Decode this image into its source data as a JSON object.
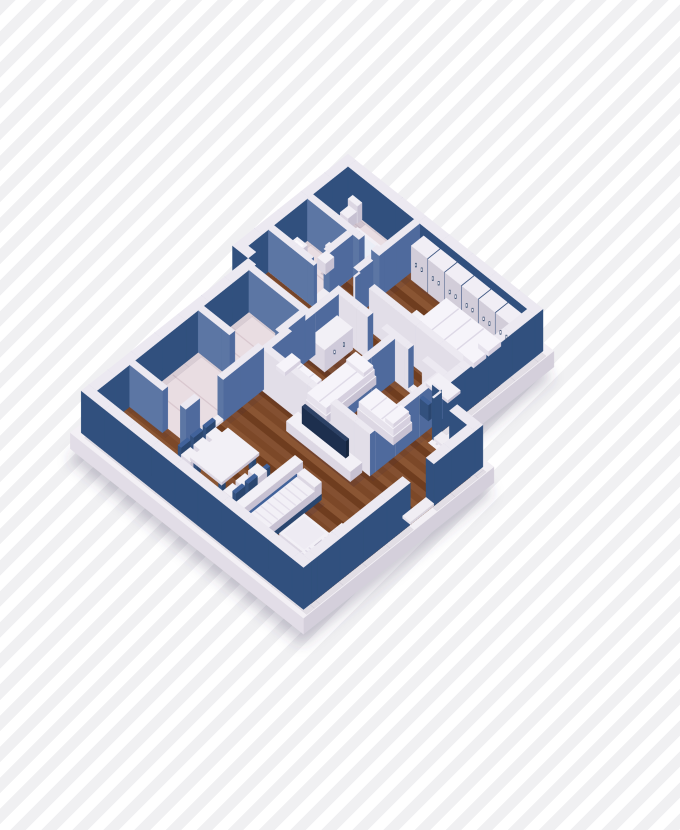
{
  "meta": {
    "title": "isometric-apartment-floorplan-render",
    "width": 680,
    "height": 830
  },
  "background": {
    "stripe_color": "#f0f0f2",
    "stripe_gap_color": "#ffffff",
    "stripe_width": 11,
    "angle_deg": 135
  },
  "projection": {
    "cx": 348,
    "cy": 196,
    "ux": 0.78,
    "uy": 0.62,
    "wall_height": 42,
    "slab_depth": 16
  },
  "colors": {
    "ext": {
      "t": "#ece9f1",
      "x": "#31507e",
      "y": "#31507e"
    },
    "intw": {
      "t": "#ece9f1",
      "x": "#4f6a9d",
      "y": "#5c76a4"
    },
    "intl": {
      "t": "#ece9f1",
      "x": "#4f6a9d",
      "y": "#e2dee8"
    },
    "furn": {
      "t": "#f2f0f6",
      "x": "#c7c1d2",
      "y": "#dcd7e3"
    },
    "ward": {
      "t": "#f1eef5",
      "x": "#3a5480",
      "y": "#d2cdd9"
    },
    "navy": {
      "t": "#41629a",
      "x": "#2a466f",
      "y": "#33517e"
    },
    "blank": {
      "t": "#f6f4fa",
      "x": "#d6d0df",
      "y": "#e6e2ec"
    },
    "th": {
      "t": "#f0edf3",
      "x": "#d8d3de",
      "y": "#e4e0e9"
    },
    "slab": {
      "t": "#f3f0f5",
      "x": "#d4cfdb",
      "y": "#e2dde7"
    },
    "tv": {
      "t": "#2c4165",
      "x": "#16263f",
      "y": "#1d2f4e"
    },
    "wood": [
      "#7c4828",
      "#8a5533",
      "#6f3d1f",
      "#845031"
    ],
    "marble": "#e9dde2",
    "vein": "#d9c8cf",
    "shadow": "rgba(60,45,80,0.14)",
    "ground_shadow": "rgba(70,60,95,0.28)",
    "handle_dark": "#2e4568",
    "handle_light": "#f5f3f8"
  },
  "slab": [
    [
      -7,
      -7,
      257,
      155,
      -16,
      0
    ],
    [
      13,
      125,
      312,
      369,
      -16,
      0
    ]
  ],
  "floors": {
    "wood": [
      [
        10,
        55,
        250,
        148
      ],
      [
        20,
        148,
        305,
        352
      ],
      [
        102,
        10,
        240,
        95
      ]
    ],
    "marble": [
      [
        10,
        10,
        95,
        55
      ],
      [
        10,
        62,
        68,
        112
      ],
      [
        30,
        157,
        95,
        215
      ],
      [
        30,
        222,
        95,
        303
      ]
    ]
  },
  "walls": [
    [
      0,
      0,
      10,
      148,
      "ext"
    ],
    [
      10,
      0,
      250,
      10,
      "ext"
    ],
    [
      240,
      10,
      250,
      132,
      "ext"
    ],
    [
      250,
      132,
      252,
      142,
      "ext"
    ],
    [
      272,
      132,
      305,
      142,
      "ext"
    ],
    [
      295,
      142,
      305,
      195,
      "ext"
    ],
    [
      295,
      225,
      305,
      352,
      "ext"
    ],
    [
      20,
      352,
      305,
      362,
      "ext"
    ],
    [
      20,
      148,
      30,
      352,
      "ext"
    ],
    [
      0,
      138,
      20,
      148,
      "ext"
    ],
    [
      10,
      55,
      76,
      62,
      "intw"
    ],
    [
      92,
      55,
      102,
      62,
      "intw"
    ],
    [
      95,
      10,
      102,
      88,
      "intw"
    ],
    [
      61,
      62,
      68,
      92,
      "intw"
    ],
    [
      61,
      108,
      68,
      112,
      "intw"
    ],
    [
      10,
      105,
      61,
      112,
      "intw"
    ],
    [
      102,
      88,
      104,
      95,
      "intl"
    ],
    [
      122,
      88,
      240,
      95,
      "intl"
    ],
    [
      100,
      112,
      144,
      119,
      "intl"
    ],
    [
      162,
      112,
      196,
      119,
      "intl"
    ],
    [
      214,
      112,
      240,
      119,
      "intl"
    ],
    [
      100,
      119,
      107,
      205,
      "intl"
    ],
    [
      100,
      205,
      240,
      212,
      "intl"
    ],
    [
      172,
      119,
      179,
      205,
      "intl"
    ],
    [
      233,
      119,
      240,
      205,
      "intl"
    ],
    [
      30,
      150,
      102,
      157,
      "intw"
    ],
    [
      95,
      157,
      102,
      188,
      "intw"
    ],
    [
      95,
      210,
      102,
      262,
      "intw"
    ],
    [
      95,
      292,
      102,
      310,
      "intw"
    ],
    [
      30,
      215,
      70,
      222,
      "intw"
    ],
    [
      30,
      303,
      72,
      310,
      "intw"
    ]
  ],
  "thresholds": [
    [
      76,
      55,
      92,
      62
    ],
    [
      61,
      92,
      68,
      108
    ],
    [
      104,
      88,
      122,
      95
    ],
    [
      144,
      112,
      162,
      119
    ],
    [
      196,
      112,
      214,
      119
    ],
    [
      95,
      188,
      102,
      210
    ],
    [
      95,
      262,
      102,
      292
    ],
    [
      252,
      132,
      272,
      142
    ],
    [
      295,
      195,
      305,
      225
    ]
  ],
  "furniture": [
    {
      "n": "toilet-a-tank",
      "b": [
        16,
        10,
        28,
        16,
        0,
        17
      ],
      "t": "furn"
    },
    {
      "n": "toilet-a-bowl",
      "b": [
        17,
        16,
        27,
        27,
        0,
        11
      ],
      "t": "furn",
      "o": 1
    },
    {
      "n": "bathtub",
      "b": [
        40,
        28,
        92,
        52,
        0,
        11
      ],
      "t": "furn",
      "deco": [
        [
          44,
          31.5,
          88,
          48.5,
          "#eaeef6"
        ]
      ]
    },
    {
      "n": "washing-machine",
      "b": [
        82,
        13,
        95,
        26,
        0,
        16
      ],
      "t": "furn",
      "fy": "#d0cad9",
      "deco": [
        [
          84,
          15,
          93,
          24,
          "#e9e5ef"
        ]
      ]
    },
    {
      "n": "wc-sink",
      "b": [
        11,
        76,
        24,
        96,
        0,
        13
      ],
      "t": "furn",
      "deco": [
        [
          13,
          79,
          22,
          93,
          "#fbfafd"
        ]
      ]
    },
    {
      "n": "wc-toilet-tank",
      "b": [
        38,
        62,
        50,
        67,
        0,
        16
      ],
      "t": "furn"
    },
    {
      "n": "wc-toilet-bowl",
      "b": [
        39,
        67,
        49,
        78,
        0,
        11
      ],
      "t": "furn",
      "o": 1
    },
    {
      "n": "wardrobe-1",
      "b": [
        108,
        11,
        128.5,
        27,
        0,
        34
      ],
      "t": "ward"
    },
    {
      "n": "wardrobe-2",
      "b": [
        129.7,
        11,
        150.2,
        27,
        0,
        34
      ],
      "t": "ward"
    },
    {
      "n": "wardrobe-3",
      "b": [
        151.4,
        11,
        171.9,
        27,
        0,
        34
      ],
      "t": "ward"
    },
    {
      "n": "wardrobe-4",
      "b": [
        173.1,
        11,
        193.6,
        27,
        0,
        34
      ],
      "t": "ward"
    },
    {
      "n": "wardrobe-5",
      "b": [
        194.8,
        11,
        215.3,
        27,
        0,
        34
      ],
      "t": "ward"
    },
    {
      "n": "wardrobe-6",
      "b": [
        216.5,
        11,
        237,
        27,
        0,
        34
      ],
      "t": "ward"
    },
    {
      "n": "double-bed-base",
      "b": [
        158,
        32,
        235,
        74,
        0,
        9
      ],
      "t": "furn",
      "fy": "#cfc9dc"
    },
    {
      "n": "double-bed-blanket",
      "b": [
        159,
        33,
        234,
        73,
        9,
        17
      ],
      "t": "blank",
      "ribs": {
        "axis": "x",
        "step": 16,
        "c": "#ddd8e6"
      }
    },
    {
      "n": "double-bed-pillow-1",
      "b": [
        220,
        37,
        233,
        53,
        17,
        22
      ],
      "t": "blank",
      "o": 2
    },
    {
      "n": "double-bed-pillow-2",
      "b": [
        220,
        56,
        233,
        72,
        17,
        22
      ],
      "t": "blank",
      "o": 2
    },
    {
      "n": "bed-bench",
      "b": [
        144,
        56,
        158,
        72,
        0,
        10
      ],
      "t": "furn"
    },
    {
      "n": "desk-top",
      "b": [
        212,
        96,
        240,
        112,
        11,
        14
      ],
      "t": "furn",
      "o": 1
    },
    {
      "n": "desk-leg-1",
      "b": [
        213,
        97,
        217,
        101,
        0,
        11
      ],
      "t": "navy"
    },
    {
      "n": "desk-leg-2",
      "b": [
        235,
        97,
        239,
        101,
        0,
        11
      ],
      "t": "navy"
    },
    {
      "n": "desk-leg-3",
      "b": [
        213,
        107,
        217,
        111,
        0,
        11
      ],
      "t": "navy"
    },
    {
      "n": "desk-leg-4",
      "b": [
        235,
        107,
        239,
        111,
        0,
        11
      ],
      "t": "navy"
    },
    {
      "n": "desk-chair-seat",
      "b": [
        222,
        115,
        233,
        126,
        0,
        8
      ],
      "t": "furn"
    },
    {
      "n": "desk-chair-back",
      "b": [
        222,
        126,
        233,
        130,
        0,
        16
      ],
      "t": "navy",
      "o": 1
    },
    {
      "n": "kids-cabinet",
      "b": [
        107,
        121,
        127,
        157,
        0,
        22
      ],
      "t": "furn",
      "fx": "#cfcada"
    },
    {
      "n": "kids-bed-a-base",
      "b": [
        144,
        134,
        170,
        198,
        0,
        8
      ],
      "t": "furn"
    },
    {
      "n": "kids-bed-a-blanket",
      "b": [
        145,
        135,
        169,
        197,
        8,
        15
      ],
      "t": "blank",
      "ribs": {
        "axis": "x",
        "step": 14,
        "c": "#e0dbe8"
      }
    },
    {
      "n": "kids-bed-a-pillow",
      "b": [
        146,
        136,
        168,
        148,
        15,
        19
      ],
      "t": "blank",
      "o": 2
    },
    {
      "n": "kids-bed-b-base",
      "b": [
        104,
        176,
        144,
        200,
        0,
        8
      ],
      "t": "furn"
    },
    {
      "n": "kids-bed-b-blanket",
      "b": [
        105,
        177,
        143,
        199,
        8,
        15
      ],
      "t": "blank",
      "ribs": {
        "axis": "x",
        "step": 14,
        "c": "#e0dbe8"
      }
    },
    {
      "n": "kids-bed-b-pillow",
      "b": [
        106,
        178,
        117,
        198,
        15,
        19
      ],
      "t": "blank",
      "o": 2
    },
    {
      "n": "kids-bed-c-base",
      "b": [
        184,
        148,
        230,
        172,
        0,
        8
      ],
      "t": "furn"
    },
    {
      "n": "kids-bed-c-blanket",
      "b": [
        185,
        149,
        229,
        171,
        8,
        15
      ],
      "t": "blank",
      "ribs": {
        "axis": "x",
        "step": 14,
        "c": "#e0dbe8"
      }
    },
    {
      "n": "kids-bed-c-pillow",
      "b": [
        218,
        150,
        228,
        170,
        15,
        19
      ],
      "t": "blank",
      "o": 2
    },
    {
      "n": "tv-console",
      "b": [
        150,
        214,
        232,
        229,
        0,
        10
      ],
      "t": "furn"
    },
    {
      "n": "tv-screen",
      "b": [
        162,
        217,
        218,
        221,
        10,
        27
      ],
      "t": "tv",
      "o": 1
    },
    {
      "n": "dining-table-top",
      "b": [
        122,
        276,
        162,
        324,
        12,
        15
      ],
      "t": "furn",
      "o": 1
    },
    {
      "n": "table-leg-1",
      "b": [
        124,
        278,
        128,
        283,
        0,
        12
      ],
      "t": "navy"
    },
    {
      "n": "table-leg-2",
      "b": [
        156,
        278,
        160,
        283,
        0,
        12
      ],
      "t": "navy"
    },
    {
      "n": "table-leg-3",
      "b": [
        124,
        317,
        128,
        322,
        0,
        12
      ],
      "t": "navy"
    },
    {
      "n": "table-leg-4",
      "b": [
        156,
        317,
        160,
        322,
        0,
        12
      ],
      "t": "navy"
    },
    {
      "n": "chair-l1-seat",
      "b": [
        108,
        278,
        120,
        290,
        0,
        8
      ],
      "t": "furn"
    },
    {
      "n": "chair-l1-back",
      "b": [
        104,
        278,
        108,
        290,
        0,
        15
      ],
      "t": "navy"
    },
    {
      "n": "chair-l2-seat",
      "b": [
        108,
        294,
        120,
        306,
        0,
        8
      ],
      "t": "furn"
    },
    {
      "n": "chair-l2-back",
      "b": [
        104,
        294,
        108,
        306,
        0,
        15
      ],
      "t": "navy"
    },
    {
      "n": "chair-l3-seat",
      "b": [
        108,
        310,
        120,
        322,
        0,
        8
      ],
      "t": "furn"
    },
    {
      "n": "chair-l3-back",
      "b": [
        104,
        310,
        108,
        322,
        0,
        15
      ],
      "t": "navy"
    },
    {
      "n": "chair-r1-seat",
      "b": [
        164,
        280,
        176,
        292,
        0,
        8
      ],
      "t": "furn"
    },
    {
      "n": "chair-r1-back",
      "b": [
        176,
        280,
        180,
        292,
        0,
        15
      ],
      "t": "navy"
    },
    {
      "n": "chair-r2-seat",
      "b": [
        164,
        296,
        176,
        308,
        0,
        8
      ],
      "t": "furn"
    },
    {
      "n": "chair-r2-back",
      "b": [
        176,
        296,
        180,
        308,
        0,
        15
      ],
      "t": "navy"
    },
    {
      "n": "chair-r3-seat",
      "b": [
        164,
        312,
        176,
        324,
        0,
        8
      ],
      "t": "furn"
    },
    {
      "n": "chair-r3-back",
      "b": [
        176,
        312,
        180,
        324,
        0,
        15
      ],
      "t": "navy"
    },
    {
      "n": "sofa-base",
      "b": [
        196,
        262,
        228,
        348,
        0,
        6
      ],
      "t": "navy"
    },
    {
      "n": "sofa-back",
      "b": [
        196,
        264,
        206,
        346,
        6,
        26
      ],
      "t": "furn",
      "o": 1
    },
    {
      "n": "sofa-arm-1",
      "b": [
        206,
        262,
        228,
        271,
        6,
        18
      ],
      "t": "furn",
      "o": 1
    },
    {
      "n": "sofa-arm-2",
      "b": [
        206,
        339,
        228,
        348,
        6,
        18
      ],
      "t": "furn",
      "o": 1
    },
    {
      "n": "sofa-seat",
      "b": [
        205,
        271,
        228,
        339,
        6,
        14
      ],
      "t": "furn",
      "o": 1,
      "ribs": {
        "axis": "y",
        "step": 7.6,
        "c": "#e4dfeb"
      }
    },
    {
      "n": "coffee-table",
      "b": [
        236,
        292,
        268,
        324,
        0,
        10
      ],
      "t": "furn",
      "deco": [
        [
          239,
          295,
          265,
          321,
          "#eeebf3"
        ]
      ]
    },
    {
      "n": "armchair-1-base",
      "b": [
        270,
        278,
        294,
        306,
        0,
        4
      ],
      "t": "navy"
    },
    {
      "n": "armchair-1-cushion",
      "b": [
        271,
        279,
        289,
        305,
        4,
        14
      ],
      "t": "furn",
      "o": 1,
      "ribs": {
        "axis": "y",
        "step": 4.4,
        "c": "#e0dbe8"
      }
    },
    {
      "n": "armchair-1-back",
      "b": [
        289,
        278,
        294,
        306,
        4,
        17
      ],
      "t": "furn",
      "o": 1
    },
    {
      "n": "armchair-2-base",
      "b": [
        268,
        314,
        292,
        340,
        0,
        4
      ],
      "t": "navy"
    },
    {
      "n": "armchair-2-cushion",
      "b": [
        269,
        315,
        287,
        339,
        4,
        14
      ],
      "t": "furn",
      "o": 1,
      "ribs": {
        "axis": "y",
        "step": 4.4,
        "c": "#e0dbe8"
      }
    },
    {
      "n": "armchair-2-back",
      "b": [
        287,
        314,
        292,
        340,
        4,
        17
      ],
      "t": "furn",
      "o": 1
    }
  ],
  "handles": {
    "wardrobe_y": {
      "y": 27.6,
      "z": 19,
      "xs": [
        114.5,
        122,
        136.2,
        143.7,
        157.9,
        165.4,
        179.6,
        187.1,
        201.3,
        208.8,
        223,
        230.5
      ]
    },
    "cabinet_x": {
      "x": 127.6,
      "z": 13,
      "ys": [
        133,
        145
      ]
    }
  },
  "rooms": [
    {
      "name": "bathroom",
      "floor": "marble"
    },
    {
      "name": "wc",
      "floor": "marble"
    },
    {
      "name": "bedroom-wardrobe-wall",
      "floor": "wood"
    },
    {
      "name": "kids-room",
      "floor": "wood"
    },
    {
      "name": "hallway",
      "floor": "wood"
    },
    {
      "name": "storage-room-1",
      "floor": "marble"
    },
    {
      "name": "storage-room-2",
      "floor": "marble"
    },
    {
      "name": "living-dining-room",
      "floor": "wood"
    }
  ]
}
